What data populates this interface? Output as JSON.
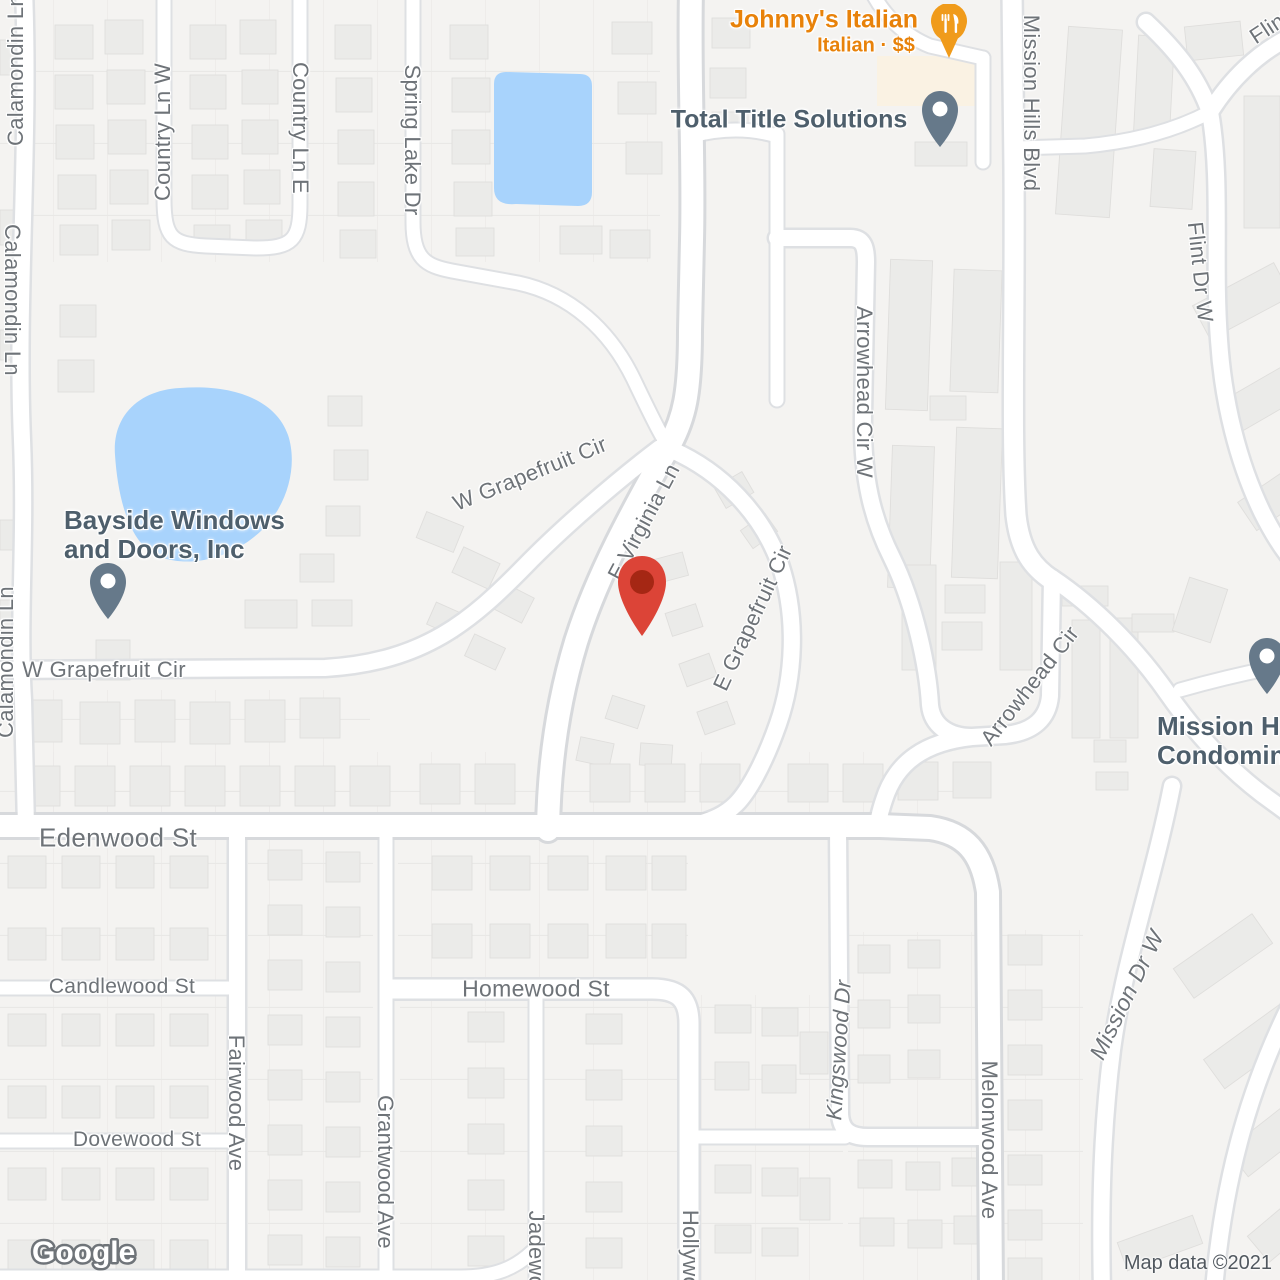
{
  "map": {
    "attribution": "Map data ©2021",
    "logo_text": "Google"
  },
  "colors": {
    "land": "#F4F3F1",
    "water": "#A8D3FC",
    "road_fill": "#FFFFFF",
    "road_casing": "#DEE0E3",
    "major_casing": "#D7D9DC",
    "building_fill": "#EBEBE9",
    "building_stroke": "#DFDEDC",
    "commercial_fill": "#FAF2E3",
    "parcel_line": "#E6E5E3",
    "street_label": "#6E7378",
    "poi_label": "#4E5F6C",
    "restaurant_label": "#E8820A",
    "restaurant_pin": "#F09B1B",
    "poi_pin": "#66798A",
    "destination_pin": "#DC4437",
    "destination_pin_inner": "#A52714"
  },
  "destination_pin": {
    "x": 641,
    "y": 584
  },
  "pois": {
    "johnnys": {
      "title": "Johnny's Italian",
      "subtitle": "Italian · $$",
      "category": "restaurant"
    },
    "total_title": {
      "title": "Total Title Solutions"
    },
    "bayside": {
      "title_line1": "Bayside Windows",
      "title_line2": "and Doors, Inc"
    },
    "mission_condo": {
      "title_line1": "Mission H",
      "title_line2": "Condominiu"
    }
  },
  "streets": [
    {
      "label": "Calamondin Ln",
      "x": 16,
      "y": 70,
      "rot": -90,
      "size": 22
    },
    {
      "label": "Calamondin Ln",
      "x": 12,
      "y": 300,
      "rot": 90,
      "size": 22
    },
    {
      "label": "Calamondin Ln",
      "x": 6,
      "y": 662,
      "rot": -90,
      "size": 22
    },
    {
      "label": "Country Ln W",
      "x": 163,
      "y": 132,
      "rot": -90,
      "size": 22
    },
    {
      "label": "Country Ln E",
      "x": 300,
      "y": 128,
      "rot": 90,
      "size": 22
    },
    {
      "label": "Spring Lake Dr",
      "x": 412,
      "y": 140,
      "rot": 90,
      "size": 22
    },
    {
      "label": "Mission Hills Blvd",
      "x": 1031,
      "y": 103,
      "rot": 90,
      "size": 22
    },
    {
      "label": "Flint",
      "x": 1270,
      "y": 27,
      "rot": -33,
      "size": 22
    },
    {
      "label": "Flint Dr W",
      "x": 1200,
      "y": 272,
      "rot": 84,
      "size": 22
    },
    {
      "label": "Arrowhead Cir W",
      "x": 864,
      "y": 392,
      "rot": 90,
      "size": 22
    },
    {
      "label": "W Grapefruit Cir",
      "x": 530,
      "y": 474,
      "rot": -22,
      "size": 22
    },
    {
      "label": "E Virginia Ln",
      "x": 644,
      "y": 522,
      "rot": -62,
      "size": 22
    },
    {
      "label": "E Grapefruit Cir",
      "x": 753,
      "y": 618,
      "rot": -65,
      "size": 22
    },
    {
      "label": "W Grapefruit Cir",
      "x": 104,
      "y": 670,
      "rot": 0,
      "size": 22
    },
    {
      "label": "Arrowhead Cir",
      "x": 1030,
      "y": 686,
      "rot": -52,
      "size": 22
    },
    {
      "label": "Edenwood St",
      "x": 118,
      "y": 838,
      "rot": 0,
      "size": 26
    },
    {
      "label": "Candlewood St",
      "x": 122,
      "y": 987,
      "rot": 0,
      "size": 21
    },
    {
      "label": "Dovewood St",
      "x": 137,
      "y": 1140,
      "rot": 0,
      "size": 21
    },
    {
      "label": "Fairwood Ave",
      "x": 236,
      "y": 1103,
      "rot": 90,
      "size": 22
    },
    {
      "label": "Grantwood Ave",
      "x": 385,
      "y": 1172,
      "rot": 90,
      "size": 22
    },
    {
      "label": "Homewood St",
      "x": 536,
      "y": 989,
      "rot": 0,
      "size": 23
    },
    {
      "label": "Jadewood",
      "x": 536,
      "y": 1262,
      "rot": 90,
      "size": 22
    },
    {
      "label": "Hollywood",
      "x": 690,
      "y": 1262,
      "rot": 90,
      "size": 22
    },
    {
      "label": "Kingswood Dr",
      "x": 839,
      "y": 1050,
      "rot": -86,
      "size": 22,
      "italic": true
    },
    {
      "label": "Melonwood Ave",
      "x": 989,
      "y": 1140,
      "rot": 90,
      "size": 22
    },
    {
      "label": "Mission Dr W",
      "x": 1127,
      "y": 995,
      "rot": -64,
      "size": 23,
      "italic": true
    }
  ]
}
